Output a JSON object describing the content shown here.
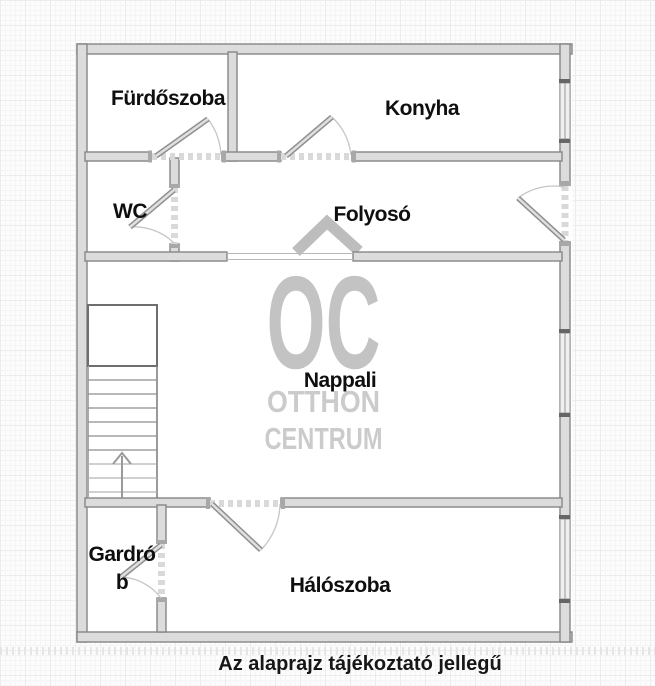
{
  "rooms": {
    "furdoszoba": "Fürdőszoba",
    "konyha": "Konyha",
    "wc": "WC",
    "folyoso": "Folyosó",
    "nappali": "Nappali",
    "gardrob": "Gardrób",
    "haloszoba": "Hálószoba"
  },
  "watermark": {
    "initials": "OC",
    "line1": "OTTHON",
    "line2": "CENTRUM"
  },
  "caption": "Az alaprajz tájékoztató jellegű",
  "colors": {
    "wall_fill": "#dcdcdc",
    "wall_line": "#868686",
    "watermark_logo": "#c3c3c3",
    "watermark_text": "#cbcbcb",
    "label_text": "#0f0f0f",
    "background": "#fcfcfc"
  }
}
